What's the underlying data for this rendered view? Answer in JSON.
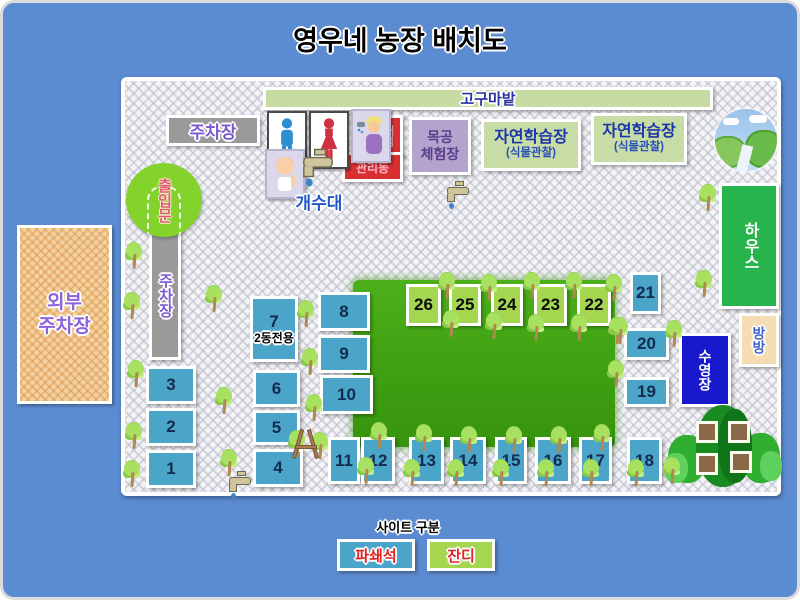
{
  "title": "영우네 농장 배치도",
  "facilities": {
    "sweet_potato_field": "고구마밭",
    "top_parking": "주차장",
    "left_parking": "주차장",
    "entrance": "출입문",
    "sink": "개수대",
    "store_vertical": "매점",
    "store_horizontal": "관리동",
    "woodwork_line1": "목공",
    "woodwork_line2": "체험장",
    "nature_title": "자연학습장",
    "nature_sub": "(식물관찰)",
    "house": "하우스",
    "bounce": "방방",
    "pool": "수영장",
    "site7_note": "2동전용"
  },
  "outside_parking": {
    "line1": "외부",
    "line2": "주차장"
  },
  "legend": {
    "title": "사이트 구분",
    "crushed_stone": "파쇄석",
    "grass": "잔디"
  },
  "sites": [
    {
      "num": "1",
      "type": "파쇄석"
    },
    {
      "num": "2",
      "type": "파쇄석"
    },
    {
      "num": "3",
      "type": "파쇄석"
    },
    {
      "num": "4",
      "type": "파쇄석"
    },
    {
      "num": "5",
      "type": "파쇄석"
    },
    {
      "num": "6",
      "type": "파쇄석"
    },
    {
      "num": "7",
      "type": "파쇄석"
    },
    {
      "num": "8",
      "type": "파쇄석"
    },
    {
      "num": "9",
      "type": "파쇄석"
    },
    {
      "num": "10",
      "type": "파쇄석"
    },
    {
      "num": "11",
      "type": "파쇄석"
    },
    {
      "num": "12",
      "type": "파쇄석"
    },
    {
      "num": "13",
      "type": "파쇄석"
    },
    {
      "num": "14",
      "type": "파쇄석"
    },
    {
      "num": "15",
      "type": "파쇄석"
    },
    {
      "num": "16",
      "type": "파쇄석"
    },
    {
      "num": "17",
      "type": "파쇄석"
    },
    {
      "num": "18",
      "type": "파쇄석"
    },
    {
      "num": "19",
      "type": "파쇄석"
    },
    {
      "num": "20",
      "type": "파쇄석"
    },
    {
      "num": "21",
      "type": "파쇄석"
    },
    {
      "num": "22",
      "type": "잔디"
    },
    {
      "num": "23",
      "type": "잔디"
    },
    {
      "num": "24",
      "type": "잔디"
    },
    {
      "num": "25",
      "type": "잔디"
    },
    {
      "num": "26",
      "type": "잔디"
    }
  ],
  "icons": [
    "male-toilet-icon",
    "female-toilet-icon",
    "shower-person-icon",
    "baby-icon",
    "faucet-icon",
    "landscape-icon",
    "tree-icon",
    "treehouse-icon",
    "a-frame-icon",
    "entrance-gate-icon"
  ],
  "colors": {
    "background": "#5b8bd0",
    "site_crushed": "#4aa5c8",
    "site_grass": "#a4d650",
    "lawn": "#3fa012",
    "pool": "#1818cc",
    "house": "#28b44c",
    "store": "#d83030",
    "woodwork": "#b2a4cc",
    "nature": "#c8dca6",
    "sweet_potato": "#c8dba2",
    "parking_gray": "#9a9a9a",
    "entrance_green": "#84d32c",
    "outside_parking_tan": "#f2d3a4",
    "bounce_peach": "#f6dcb2"
  }
}
